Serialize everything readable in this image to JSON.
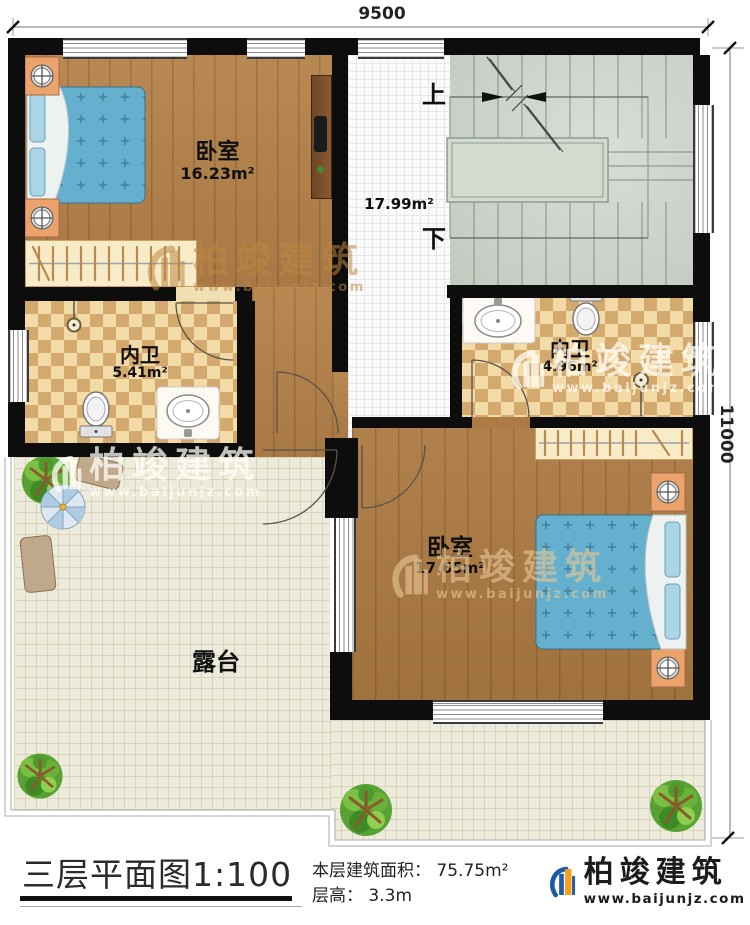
{
  "plan": {
    "dimensions": {
      "width_label": "9500",
      "height_label": "11000"
    },
    "rooms": {
      "bedroom1": {
        "name": "卧室",
        "area": "16.23m²"
      },
      "stair_hall": {
        "area": "17.99m²",
        "up_label": "上",
        "down_label": "下"
      },
      "bath1": {
        "name": "内卫",
        "area": "5.41m²"
      },
      "bath2": {
        "name": "内卫",
        "area": "4.96m²"
      },
      "bedroom2": {
        "name": "卧室",
        "area": "17.65m²"
      },
      "terrace": {
        "name": "露台"
      }
    }
  },
  "title_block": {
    "title": "三层平面图",
    "scale": "1:100",
    "floor_area_label": "本层建筑面积：",
    "floor_area_value": "75.75m²",
    "floor_height_label": "层高：",
    "floor_height_value": "3.3m"
  },
  "brand": {
    "name": "柏竣建筑",
    "website": "www.baijunjz.com"
  },
  "watermark": {
    "name": "柏竣建筑",
    "website": "www.baijunjz.com"
  },
  "colors": {
    "wall": "#0d0d0d",
    "wood": "#b5824a",
    "wood_dark": "#ac7a42",
    "tile_light": "#f2dba6",
    "tile_dark": "#d4a96e",
    "terrace": "#edebdc",
    "stair": "#ccd4ca",
    "hall": "#fbfbfb",
    "bed_blue": "#64b0ce",
    "nightstand_orange": "#eba36b",
    "logo_blue": "#1d5ca5",
    "logo_orange": "#f5a11d"
  }
}
